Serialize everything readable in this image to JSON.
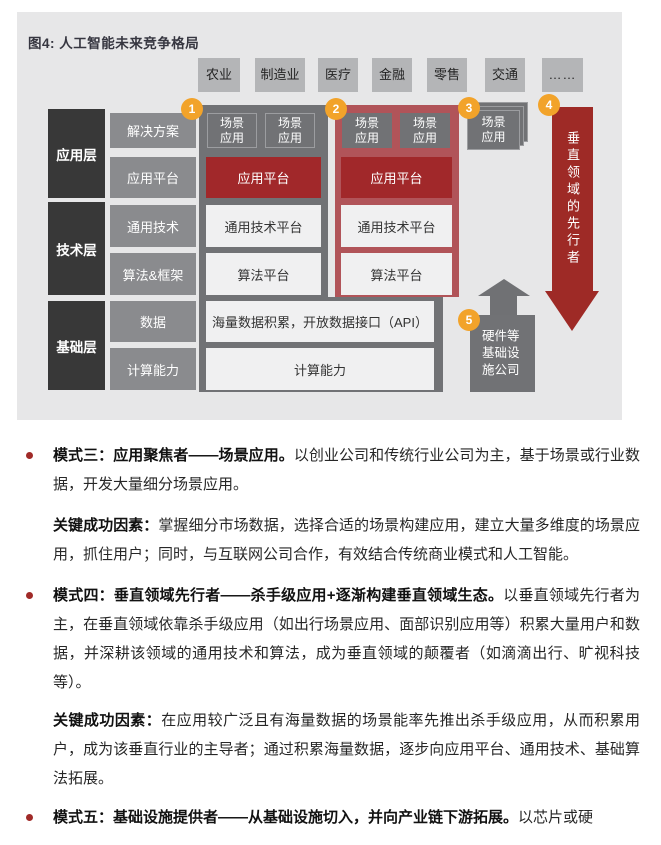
{
  "figure": {
    "title": "图4: 人工智能未来竞争格局",
    "tabs": [
      "农业",
      "制造业",
      "医疗",
      "金融",
      "零售",
      "交通",
      "……"
    ],
    "layers": [
      {
        "name": "应用层",
        "labels": [
          "解决方案",
          "应用平台"
        ]
      },
      {
        "name": "技术层",
        "labels": [
          "通用技术",
          "算法&框架"
        ]
      },
      {
        "name": "基础层",
        "labels": [
          "数据",
          "计算能力"
        ]
      }
    ],
    "badges": [
      "1",
      "2",
      "3",
      "4",
      "5"
    ],
    "boxes": {
      "scenario": "场景应用",
      "app_platform": "应用平台",
      "tech_platform": "通用技术平台",
      "algo_platform": "算法平台",
      "data_row": "海量数据积累，开放数据接口（API）",
      "compute_row": "计算能力"
    },
    "arrow_label": "垂直领域的先行者",
    "hardware_label": "硬件等基础设施公司",
    "colors": {
      "figure_bg": "#e7e7e8",
      "dark_layer": "#383838",
      "gray_label": "#8a8b8e",
      "gray_panel": "#717275",
      "red_panel": "#b15459",
      "brick_red": "#a1282a",
      "badge_orange": "#f2a32a"
    }
  },
  "content": {
    "paragraphs": [
      {
        "bold": "模式三：应用聚焦者——场景应用。",
        "text": "以创业公司和传统行业公司为主，基于场景或行业数据，开发大量细分场景应用。"
      },
      {
        "bold": "关键成功因素：",
        "text": "掌握细分市场数据，选择合适的场景构建应用，建立大量多维度的场景应用，抓住用户；同时，与互联网公司合作，有效结合传统商业模式和人工智能。"
      },
      {
        "bold": "模式四：垂直领域先行者——杀手级应用+逐渐构建垂直领域生态。",
        "text": "以垂直领域先行者为主，在垂直领域依靠杀手级应用（如出行场景应用、面部识别应用等）积累大量用户和数据，并深耕该领域的通用技术和算法，成为垂直领域的颠覆者（如滴滴出行、旷视科技等）。"
      },
      {
        "bold": "关键成功因素：",
        "text": "在应用较广泛且有海量数据的场景能率先推出杀手级应用，从而积累用户，成为该垂直行业的主导者；通过积累海量数据，逐步向应用平台、通用技术、基础算法拓展。"
      },
      {
        "bold": "模式五：基础设施提供者——从基础设施切入，并向产业链下游拓展。",
        "text": "以芯片或硬"
      }
    ]
  }
}
